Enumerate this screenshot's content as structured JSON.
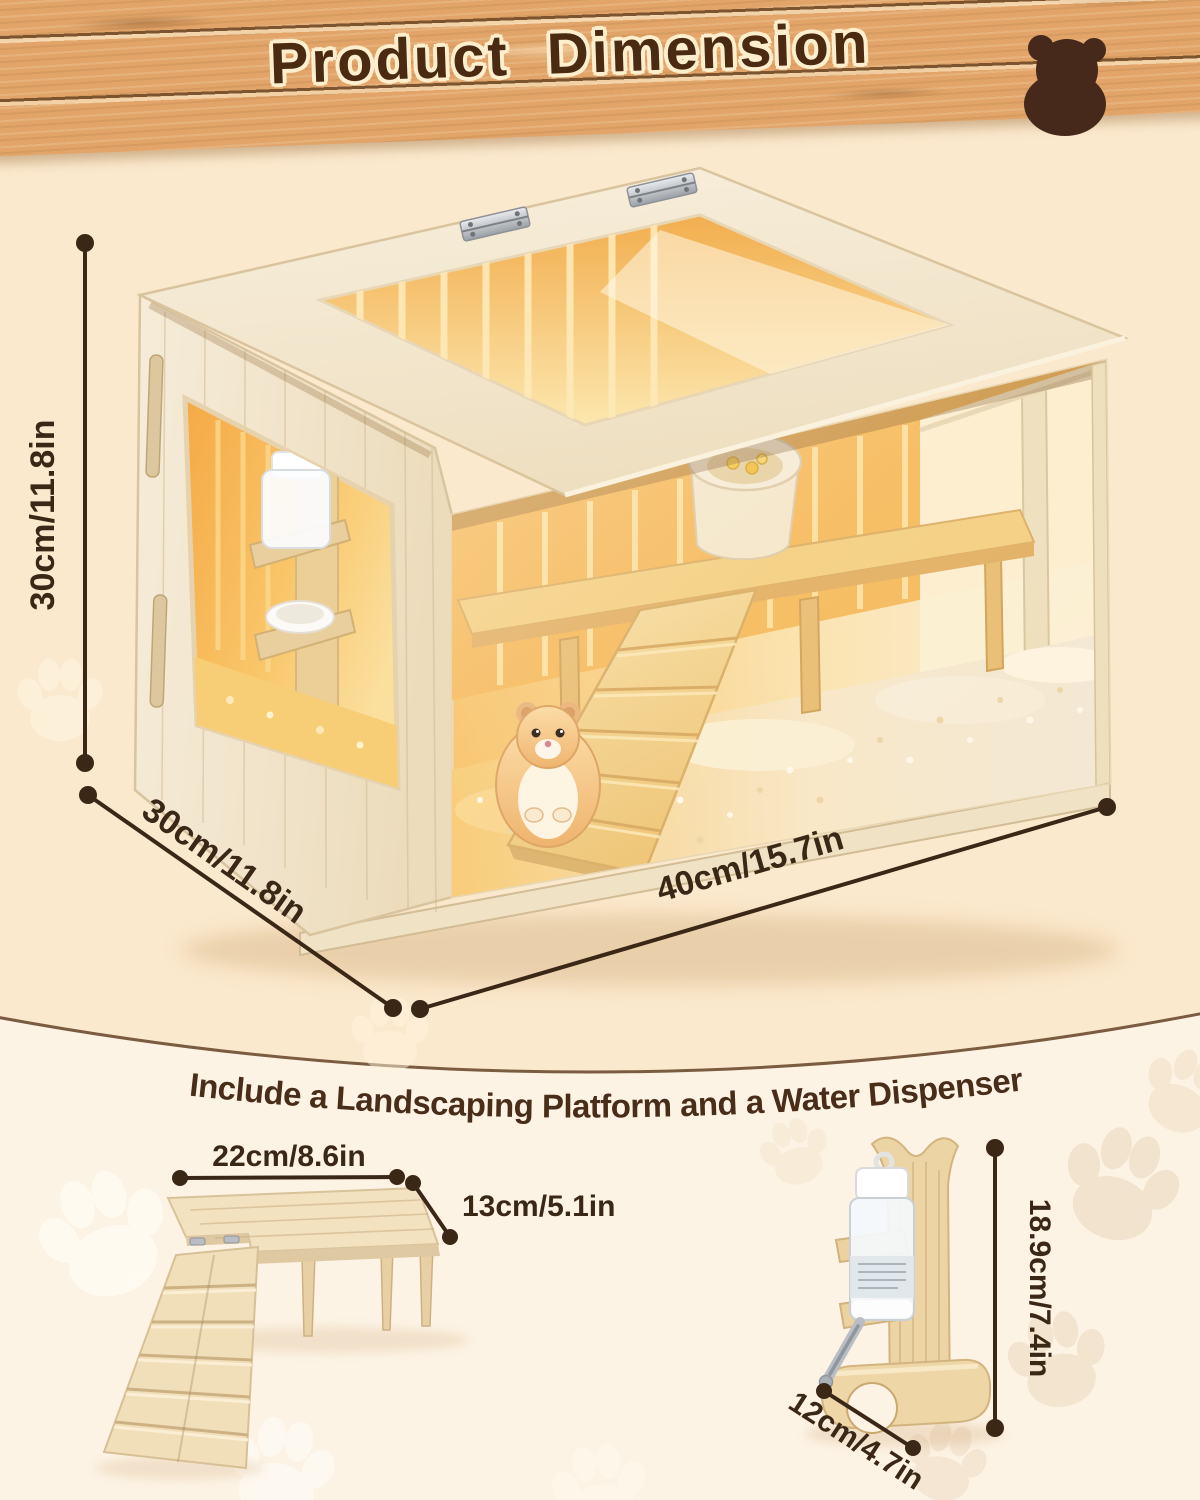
{
  "header": {
    "title": "Product Dimension"
  },
  "cage": {
    "height_label": "30cm/11.8in",
    "depth_label": "30cm/11.8in",
    "width_label": "40cm/15.7in"
  },
  "tagline": "Include a Landscaping Platform and a Water Dispenser",
  "platform": {
    "width_label": "22cm/8.6in",
    "depth_label": "13cm/5.1in"
  },
  "dispenser": {
    "height_label": "18.9cm/7.4in",
    "width_label": "12cm/4.7in"
  },
  "icons": {
    "header_icon": "bear-icon",
    "background_motif": "paw-print-icon"
  },
  "colors": {
    "accent_brown": "#3a2716",
    "title_brown": "#4a2b11",
    "upper_bg": "#fbe9cd",
    "lower_bg": "#fdf3e5",
    "wood_plank": "#e2a468",
    "interior_glow": "#f6b95c"
  }
}
